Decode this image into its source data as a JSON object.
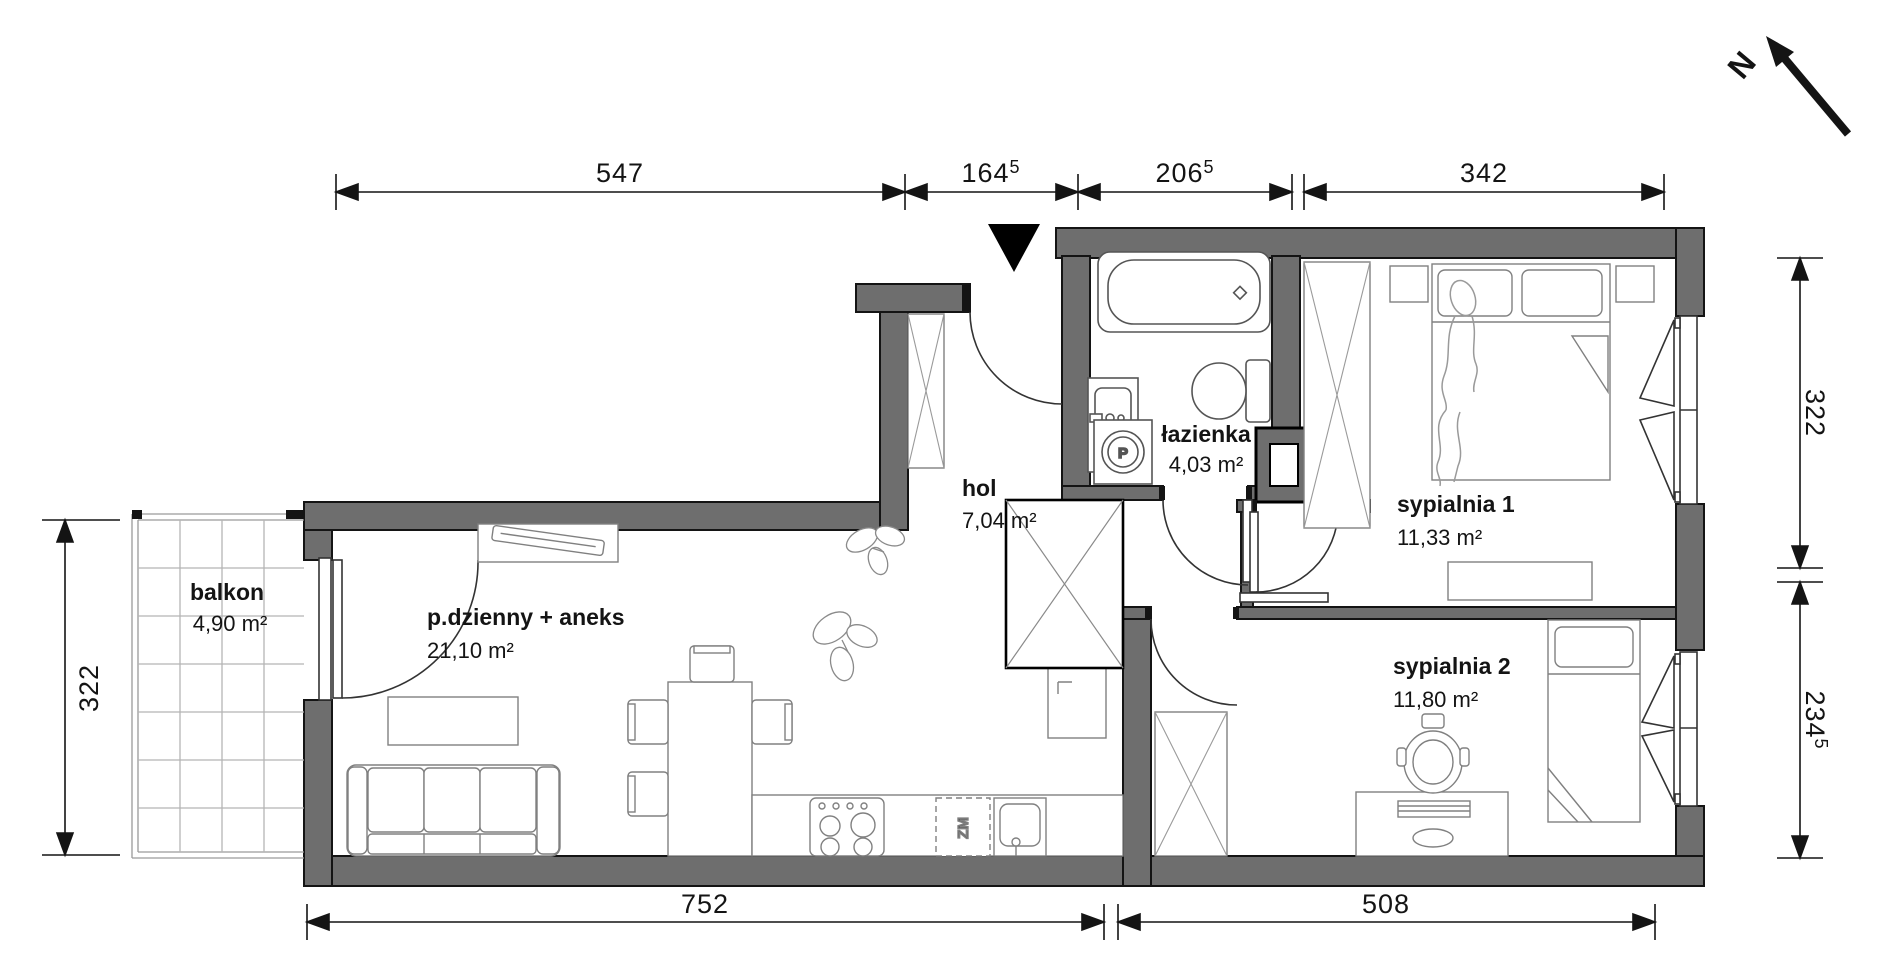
{
  "plan_title": "apartment floor plan",
  "compass": {
    "label": "N"
  },
  "rooms": [
    {
      "id": "balkon",
      "name": "balkon",
      "area": "4,90 m²"
    },
    {
      "id": "living",
      "name": "p.dzienny + aneks",
      "area": "21,10 m²"
    },
    {
      "id": "hol",
      "name": "hol",
      "area": "7,04 m²"
    },
    {
      "id": "lazienka",
      "name": "łazienka",
      "area": "4,03 m²"
    },
    {
      "id": "sypialnia1",
      "name": "sypialnia 1",
      "area": "11,33 m²"
    },
    {
      "id": "sypialnia2",
      "name": "sypialnia 2",
      "area": "11,80 m²"
    }
  ],
  "dimensions": {
    "top": [
      {
        "value": "547",
        "sup": ""
      },
      {
        "value": "164",
        "sup": "5"
      },
      {
        "value": "206",
        "sup": "5"
      },
      {
        "value": "342",
        "sup": ""
      }
    ],
    "bottom": [
      {
        "value": "752",
        "sup": ""
      },
      {
        "value": "508",
        "sup": ""
      }
    ],
    "right": [
      {
        "value": "322",
        "sup": ""
      },
      {
        "value": "234",
        "sup": "5"
      }
    ],
    "left": [
      {
        "value": "322",
        "sup": ""
      }
    ]
  },
  "appliances": {
    "dishwasher_label": "ZM",
    "washer_label": "P"
  },
  "colors": {
    "wall_fill": "#6e6e6e",
    "outline": "#141414",
    "furniture_line": "#808080"
  }
}
